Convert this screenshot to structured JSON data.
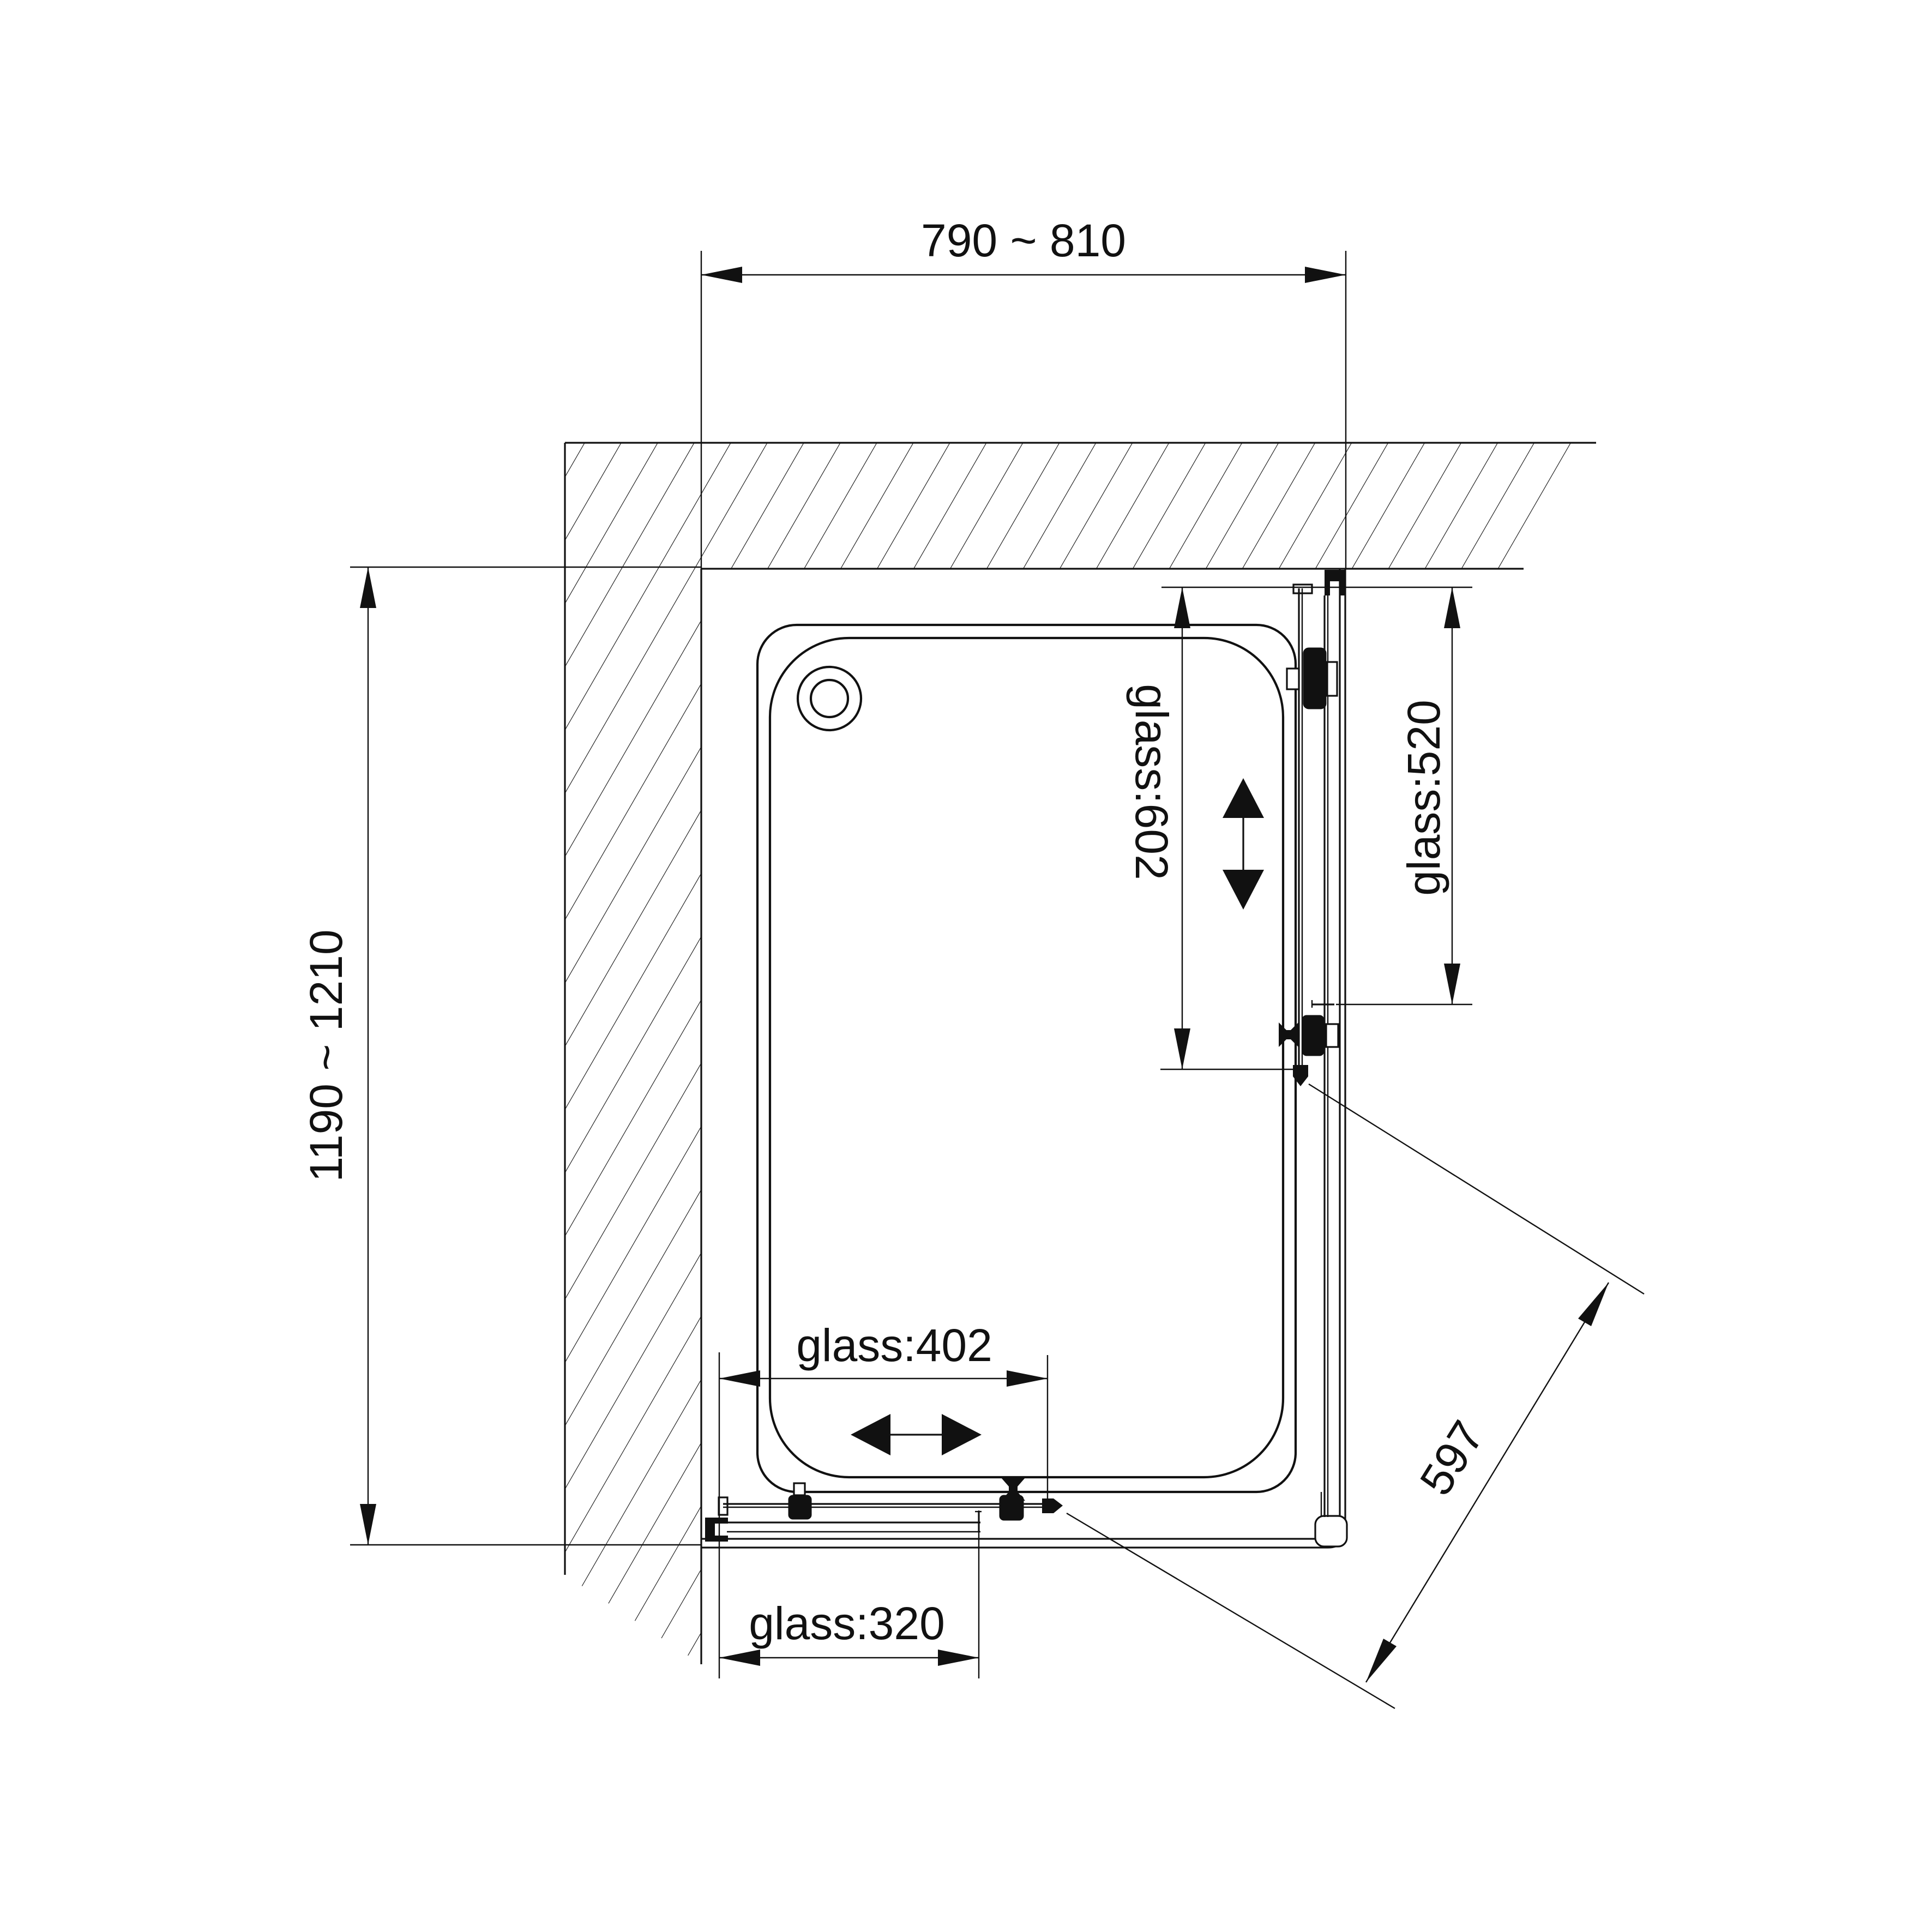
{
  "page": {
    "background": "#ffffff",
    "line_color": "#111111"
  },
  "labels": {
    "width_range": "790 ~ 810",
    "depth_range": "1190 ~ 1210",
    "right_sliding_glass": "glass:602",
    "right_fixed_glass": "glass:520",
    "bottom_sliding_glass": "glass:402",
    "bottom_fixed_glass": "glass:320",
    "diagonal": "597"
  }
}
